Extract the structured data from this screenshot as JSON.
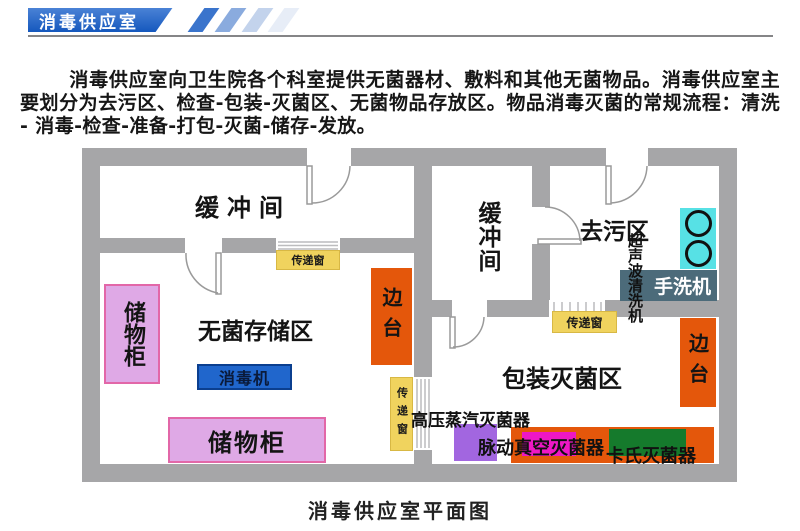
{
  "header": {
    "title": "消毒供应室"
  },
  "intro": {
    "text": "消毒供应室向卫生院各个科室提供无菌器材、敷料和其他无菌物品。消毒供应室主要划分为去污区、检查-包装-灭菌区、无菌物品存放区。物品消毒灭菌的常规流程：清洗 - 消毒-检查-准备-打包-灭菌-储存-发放。"
  },
  "plan": {
    "rooms": {
      "buffer_top_left": "缓冲间",
      "buffer_middle": "缓冲间",
      "decontamination": "去污区",
      "sterile_storage": "无菌存储区",
      "packing_sterilization": "包装灭菌区"
    },
    "equipment": {
      "cabinet_left": "储物柜",
      "cabinet_bottom": "储物柜",
      "disinfector": "消毒机",
      "side_table_left": "边台",
      "side_table_right": "边台",
      "pass_window_left": "传递窗",
      "pass_window_center": "传递窗",
      "pass_window_right": "传递窗",
      "hand_washer": "手洗机",
      "ultrasonic_cleaner": "超声波清洗机",
      "steam_sterilizer": "高压蒸汽灭菌器",
      "pulse_vacuum_sterilizer": "脉动真空灭菌器",
      "cassette_sterilizer": "卡氏灭菌器"
    }
  },
  "caption": {
    "text": "消毒供应室平面图"
  },
  "colors": {
    "banner-blue": "#1558be",
    "banner-blue-light": "#4a82d6",
    "stripe-1": "#3a74cc",
    "stripe-2": "#8aabde",
    "stripe-3": "#c3d3ec",
    "stripe-4": "#e7edf7",
    "wall": "#a6a6a8",
    "pass-window": "#f0d35e",
    "cabinet-pink": "#dfa9e6",
    "cabinet-border": "#e267a8",
    "disinfector-blue": "#2066cc",
    "disinfector-border": "#0b3f8f",
    "bench-orange": "#e4570b",
    "sink-cyan": "#57e1e5",
    "washer-slate": "#4c6b7a",
    "sterilizer-purple": "#a266e0",
    "sterilizer-magenta": "#ee17c5",
    "sterilizer-green": "#157a2c"
  }
}
